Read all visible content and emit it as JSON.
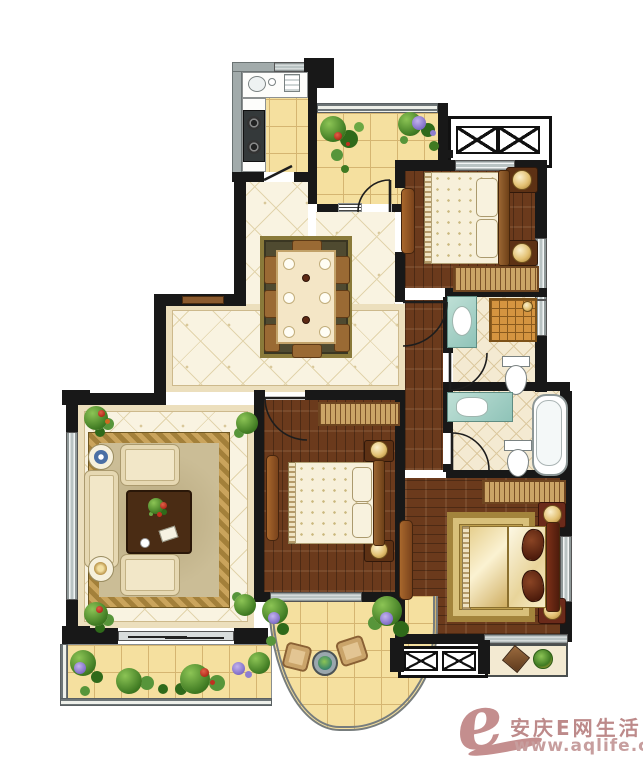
{
  "title": "residential apartment floor plan (top-down interior rendering)",
  "watermark": {
    "logo_letter": "e",
    "site_name": "安庆E网生活",
    "site_url": "www.aqlife.com",
    "logo_color": "#c48e8e",
    "text_color": "#bd8a8a"
  },
  "palette": {
    "wall_black": "#181818",
    "wall_gray": "#a2abab",
    "tile_yellow": "#f5e09f",
    "tile_grout": "#d5b571",
    "floor_cream_lattice": "#f9f3e1",
    "wood_floor": "#6b3a1c",
    "bathroom_tile": "#f4ead2",
    "furniture_cream": "#f2e7c8",
    "rug_gold": "#bfa04f",
    "dining_rug_olive": "#4f4a30",
    "plant_green": "#3f7a22",
    "flower_purple": "#7b68c4",
    "flower_red": "#b02818",
    "vanity_teal": "#8fc3b8",
    "shower_orange": "#d59440"
  },
  "rooms": [
    {
      "id": "kitchen",
      "floor": "yellow-tile",
      "furniture": [
        "l-shaped-counter",
        "sink",
        "gas-stove",
        "service-door"
      ]
    },
    {
      "id": "entry-garden-balcony",
      "floor": "yellow-tile",
      "furniture": [
        "corner-planting",
        "flower-clusters",
        "door-to-dining"
      ]
    },
    {
      "id": "ac-platform-north",
      "floor": "concrete",
      "furniture": [
        "ac-outdoor-unit-symbols"
      ]
    },
    {
      "id": "bedroom-north",
      "floor": "dark-wood",
      "furniture": [
        "double-bed",
        "two-pillows",
        "nightstand-with-lamp-x2",
        "wardrobe",
        "open-door-leaf"
      ]
    },
    {
      "id": "bathroom-north",
      "floor": "diamond-tile",
      "furniture": [
        "vanity-sink",
        "shower-with-drain",
        "toilet",
        "swing-door"
      ]
    },
    {
      "id": "dining-room",
      "floor": "cream-lattice-tile",
      "furniture": [
        "dining-table-for-eight",
        "olive-area-rug",
        "place-settings"
      ]
    },
    {
      "id": "hallway",
      "floor": "dark-wood",
      "furniture": [
        "swing-door-from-dining"
      ]
    },
    {
      "id": "living-room",
      "floor": "cream-lattice-tile",
      "furniture": [
        "three-seat-sofa",
        "armchair-x2",
        "round-side-table-x2",
        "ornate-gold-rug",
        "dark-coffee-table-with-flowers",
        "potted-plant-x4",
        "sliding-balcony-door"
      ]
    },
    {
      "id": "bedroom-middle",
      "floor": "dark-wood",
      "furniture": [
        "double-bed",
        "nightstand-with-lamp-x2",
        "wardrobe",
        "open-door-leaf",
        "window-to-balcony"
      ]
    },
    {
      "id": "bathroom-south",
      "floor": "diamond-tile",
      "furniture": [
        "vanity-sink",
        "toilet",
        "bathtub",
        "swing-door"
      ]
    },
    {
      "id": "master-bedroom",
      "floor": "dark-wood",
      "furniture": [
        "king-bed-gold-duvet",
        "dark-red-pillows",
        "nightstand-with-lamp-x2",
        "wardrobe",
        "gold-area-rug",
        "bay-window-seat-with-cushions",
        "open-door-leaf"
      ]
    },
    {
      "id": "south-balcony",
      "floor": "yellow-tile",
      "furniture": [
        "curved-balustrade",
        "leisure-chair-x2",
        "round-table",
        "perimeter-plants"
      ]
    },
    {
      "id": "ac-platform-south",
      "floor": "concrete",
      "furniture": [
        "ac-outdoor-unit-symbols"
      ]
    }
  ]
}
